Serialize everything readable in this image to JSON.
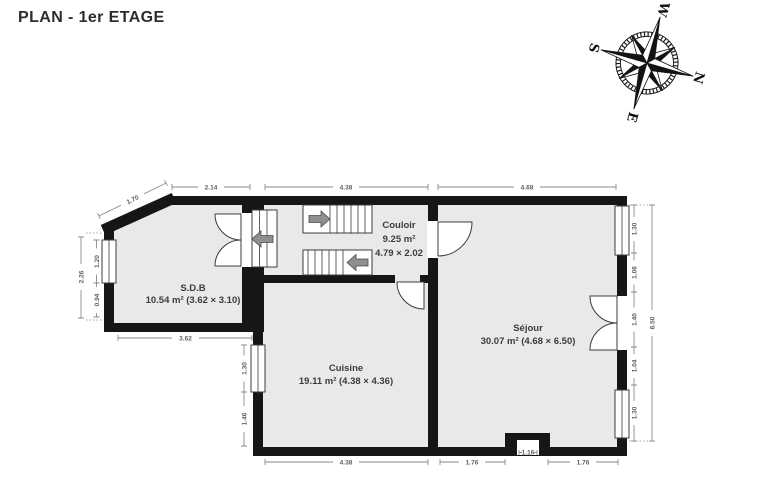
{
  "title": "PLAN - 1er ETAGE",
  "compass": {
    "n": "N",
    "e": "E",
    "s": "S",
    "w": "W"
  },
  "rooms": {
    "sdb": {
      "name": "S.D.B",
      "info": "10.54 m² (3.62 × 3.10)"
    },
    "couloir": {
      "name": "Couloir",
      "area": "9.25 m²",
      "size": "4.79 × 2.02"
    },
    "cuisine": {
      "name": "Cuisine",
      "info": "19.11 m² (4.38 × 4.36)"
    },
    "sejour": {
      "name": "Séjour",
      "info": "30.07 m² (4.68 × 6.50)"
    }
  },
  "dimensions": {
    "top_sdb": "2.14",
    "top_couloir": "4.38",
    "top_sejour": "4.68",
    "diag_sdb": "1.70",
    "left_sdb_total": "2.26",
    "left_sdb_upper": "1.20",
    "left_sdb_lower": "0.94",
    "bottom_sdb": "3.62",
    "left_cuisine_upper": "1.30",
    "left_cuisine_lower": "1.46",
    "bottom_cuisine": "4.38",
    "bottom_sejour_left": "1.76",
    "bottom_chimney": "1.16",
    "bottom_sejour_right": "1.76",
    "right_s1": "1.30",
    "right_s2": "1.06",
    "right_s3": "1.40",
    "right_s4": "1.04",
    "right_s5": "1.30",
    "right_total": "6.50"
  },
  "colors": {
    "wall": "#161616",
    "floor": "#e9e9eb",
    "dim": "#8a8a8a",
    "dim_text": "#5f5f5f",
    "label": "#3c3c3c",
    "arrow": "#8f8f8f"
  }
}
